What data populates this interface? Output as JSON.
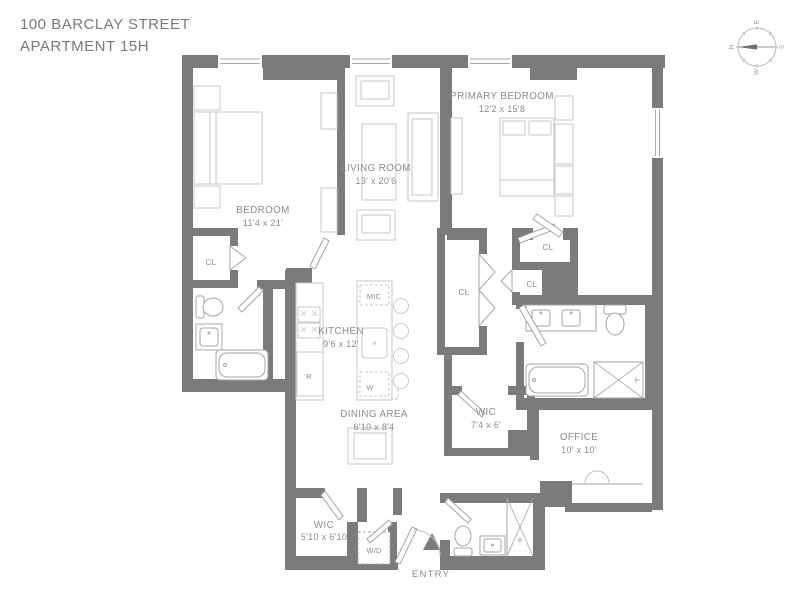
{
  "title": {
    "line1": "100 BARCLAY STREET",
    "line2": "APARTMENT 15H"
  },
  "compass": {
    "north": "N",
    "east": "E",
    "south": "S",
    "west": "W"
  },
  "rooms": {
    "bedroom": {
      "name": "BEDROOM",
      "dims": "11'4 x 21'"
    },
    "living_room": {
      "name": "LIVING ROOM",
      "dims": "13' x 20'6"
    },
    "primary_bedroom": {
      "name": "PRIMARY BEDROOM",
      "dims": "12'2 x 15'8"
    },
    "kitchen": {
      "name": "KITCHEN",
      "dims": "9'6 x 12'"
    },
    "dining_area": {
      "name": "DINING AREA",
      "dims": "6'10 x 8'4"
    },
    "wic_primary": {
      "name": "WIC",
      "dims": "7'4 x 6'"
    },
    "office": {
      "name": "OFFICE",
      "dims": "10' x 10'"
    },
    "wic_entry": {
      "name": "WIC",
      "dims": "5'10 x 6'10"
    },
    "entry": {
      "name": "ENTRY"
    }
  },
  "closets": {
    "bedroom_cl": "CL",
    "hall_cl": "CL",
    "primary_cl_1": "CL",
    "primary_cl_2": "CL"
  },
  "appliances": {
    "microwave": "MIC",
    "wine_cooler": "W",
    "refrigerator": "R",
    "washer_dryer": "W/D"
  },
  "colors": {
    "wall": "#7b7b7b",
    "label": "#8d8d8d",
    "furniture": "#c9c9c9",
    "fixture": "#a6a6a6",
    "window": "#aaaaaa"
  }
}
